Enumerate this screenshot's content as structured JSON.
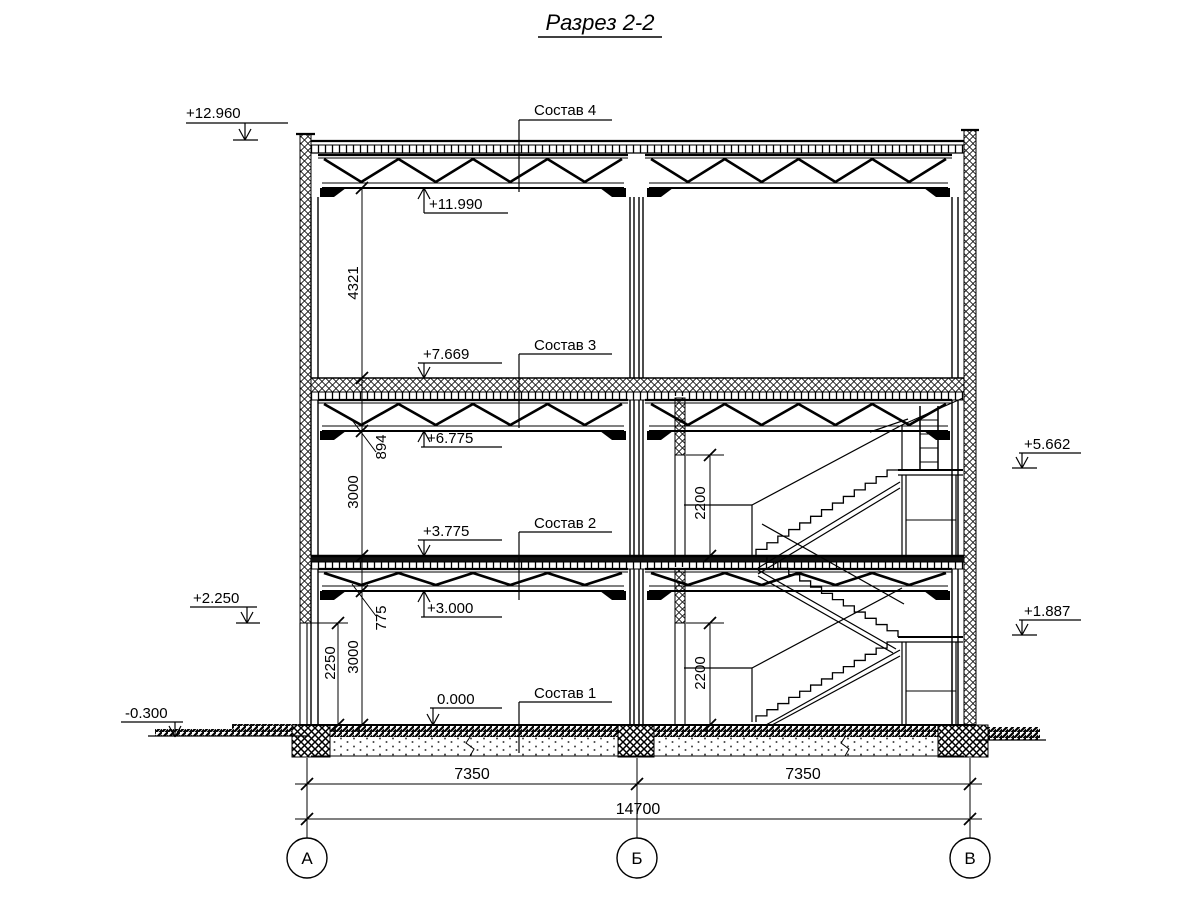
{
  "title": "Разрез 2-2",
  "elevation_marks": {
    "parapet_top": "+12.960",
    "roof_truss_bottom": "+11.990",
    "floor3_slab_top": "+7.669",
    "floor3_truss_bottom": "+6.775",
    "floor2_slab_top": "+3.775",
    "floor2_truss_bottom": "+3.000",
    "ground_floor": "0.000",
    "wall_panel_bottom": "+2.250",
    "outside_ground": "-0.300",
    "stair_landing_upper": "+5.662",
    "stair_landing_lower": "+1.887"
  },
  "layer_labels": {
    "roof": "Состав 4",
    "floor3": "Состав 3",
    "floor2": "Состав 2",
    "floor1": "Состав 1"
  },
  "vertical_dimensions": {
    "roof_clearance": "4321",
    "floor3_structure_depth": "894",
    "storey2_height": "3000",
    "floor2_structure_depth": "775",
    "storey1_height": "3000",
    "panel_bottom_height": "2250",
    "opening_upper": "2200",
    "opening_lower": "2200"
  },
  "horizontal_dimensions": {
    "span_left": "7350",
    "span_right": "7350",
    "total": "14700"
  },
  "axes": [
    {
      "label": "А"
    },
    {
      "label": "Б"
    },
    {
      "label": "В"
    }
  ]
}
